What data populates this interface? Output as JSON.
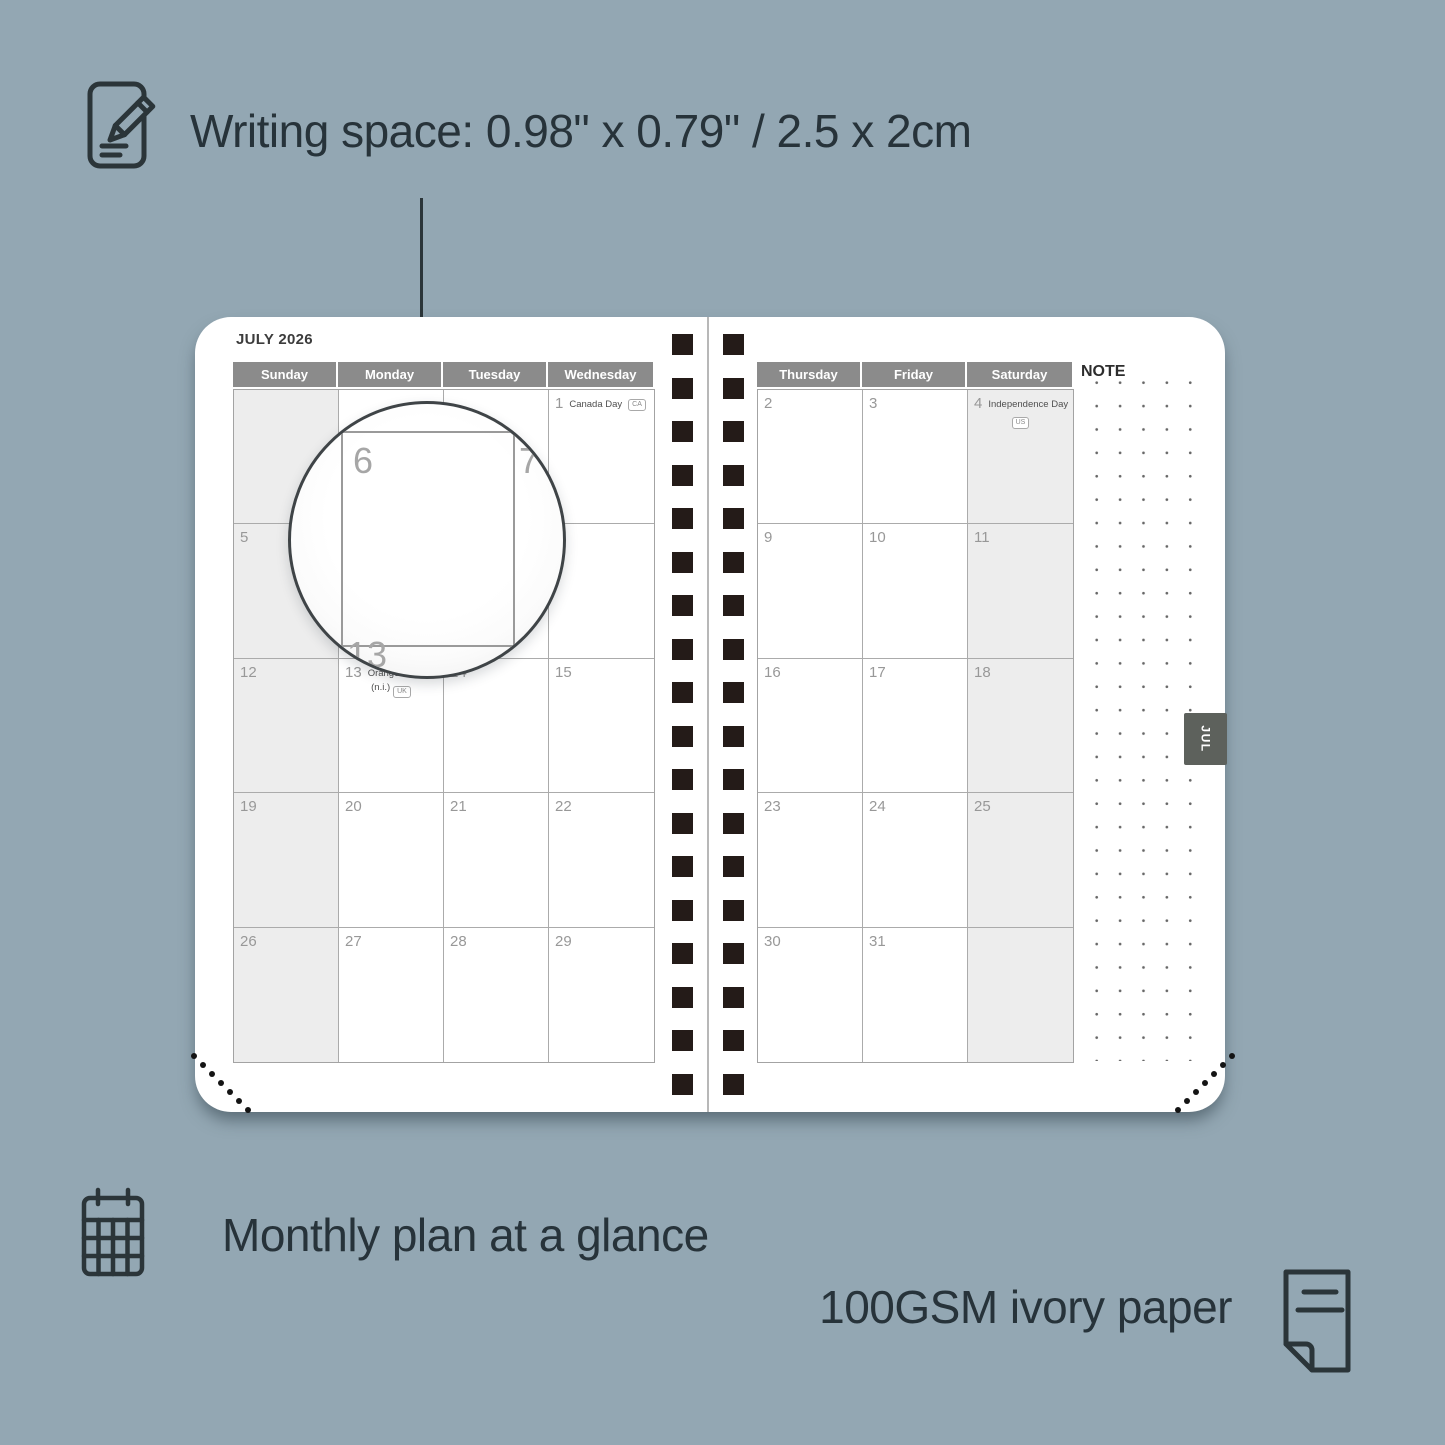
{
  "annotations": {
    "writing_space": "Writing space: 0.98\" x 0.79\" / 2.5 x 2cm",
    "monthly_plan": "Monthly plan at a glance",
    "paper": "100GSM ivory paper"
  },
  "colors": {
    "background": "#93a7b3",
    "ink": "#27333a",
    "header_bg": "#8b8b8b",
    "shaded_cell": "#ededed",
    "binding_square": "#241b18",
    "tab_bg": "#5d615c"
  },
  "icons": {
    "writing": "notepad-pencil-icon",
    "monthly": "calendar-grid-icon",
    "paper": "paper-sheet-icon"
  },
  "planner": {
    "title": "JULY 2026",
    "tab": "JUL",
    "note_label": "NOTE",
    "left_headers": [
      "Sunday",
      "Monday",
      "Tuesday",
      "Wednesday"
    ],
    "right_headers": [
      "Thursday",
      "Friday",
      "Saturday"
    ],
    "left_rows": [
      [
        {
          "day": ""
        },
        {
          "day": ""
        },
        {
          "day": ""
        },
        {
          "day": "1",
          "holiday": "Canada Day",
          "badge": "CA"
        }
      ],
      [
        {
          "day": "5"
        },
        {
          "day": "6"
        },
        {
          "day": "7"
        },
        {
          "day": "8"
        }
      ],
      [
        {
          "day": "12"
        },
        {
          "day": "13",
          "holiday": "Orangemen's Day",
          "holiday2": "(n.i.)",
          "badge": "UK"
        },
        {
          "day": "14"
        },
        {
          "day": "15"
        }
      ],
      [
        {
          "day": "19"
        },
        {
          "day": "20"
        },
        {
          "day": "21"
        },
        {
          "day": "22"
        }
      ],
      [
        {
          "day": "26"
        },
        {
          "day": "27"
        },
        {
          "day": "28"
        },
        {
          "day": "29"
        }
      ]
    ],
    "right_rows": [
      [
        {
          "day": "2"
        },
        {
          "day": "3"
        },
        {
          "day": "4",
          "holiday": "Independence Day",
          "badge": "US"
        }
      ],
      [
        {
          "day": "9"
        },
        {
          "day": "10"
        },
        {
          "day": "11"
        }
      ],
      [
        {
          "day": "16"
        },
        {
          "day": "17"
        },
        {
          "day": "18"
        }
      ],
      [
        {
          "day": "23"
        },
        {
          "day": "24"
        },
        {
          "day": "25"
        }
      ],
      [
        {
          "day": "30"
        },
        {
          "day": "31"
        },
        {
          "day": ""
        }
      ]
    ],
    "magnifier": {
      "zoom_day": "6",
      "adjacent_day": "7",
      "below_day": "13"
    }
  }
}
